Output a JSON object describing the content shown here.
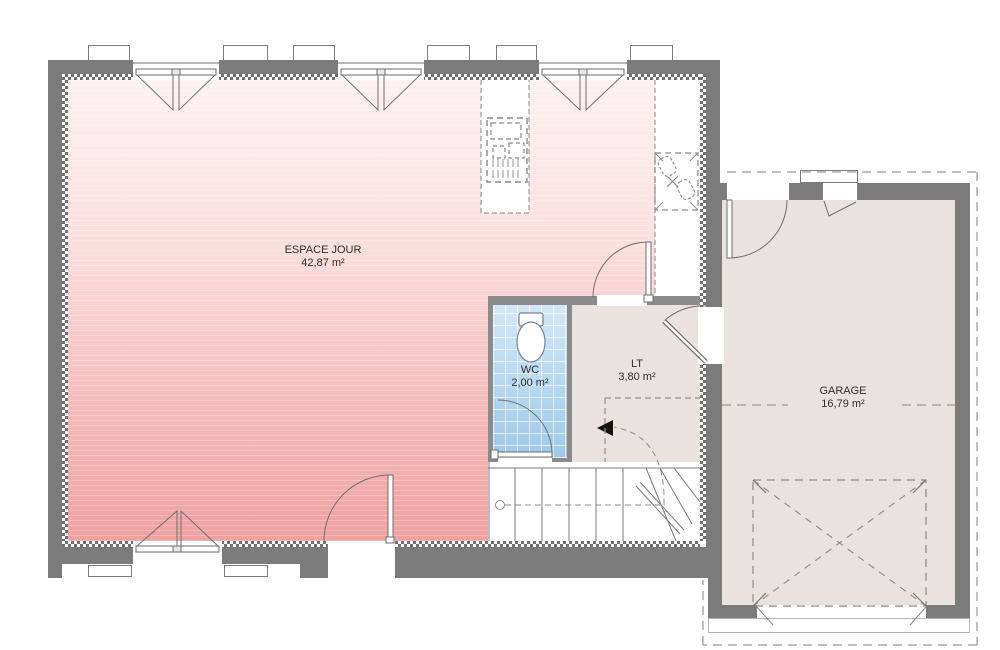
{
  "plan": {
    "rooms": [
      {
        "id": "espace-jour",
        "label": "ESPACE JOUR",
        "area": "42,87 m²"
      },
      {
        "id": "wc",
        "label": "WC",
        "area": "2,00 m²"
      },
      {
        "id": "lt",
        "label": "LT",
        "area": "3,80 m²"
      },
      {
        "id": "garage",
        "label": "GARAGE",
        "area": "16,79 m²"
      }
    ],
    "colors": {
      "exterior_wall": "#7b7b7b",
      "interior_wall": "#8b8b8b",
      "day_floor_top": "#fdf1f1",
      "day_floor_bottom": "#efa1a1",
      "wc_floor": "#b5d7f0",
      "service_floor": "#eae2de",
      "line": "#6e6e6e",
      "dashed_line": "#8f8f8f"
    },
    "icons": [
      "toilet-icon",
      "sink-icon",
      "cooktop-icon",
      "stairs-icon",
      "entrance-arrow-icon",
      "door-swing-icon",
      "window-icon"
    ]
  }
}
